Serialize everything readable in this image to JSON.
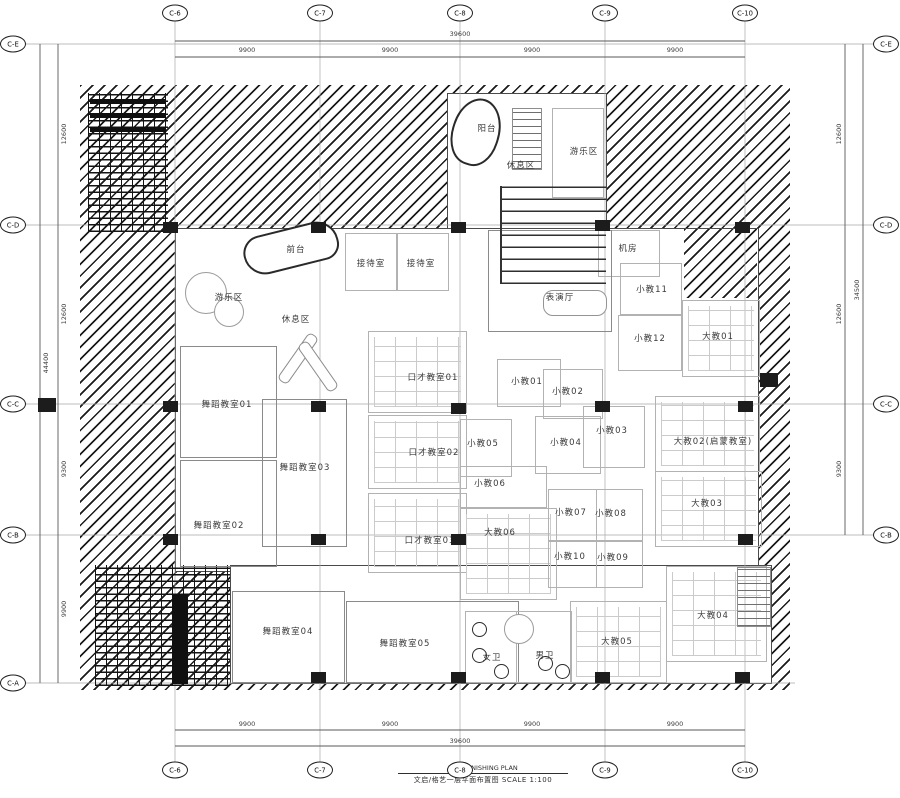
{
  "drawing": {
    "title_en": "F1 FURNISHING PLAN",
    "title_cn": "文启/格艺一层平面布置图",
    "scale": "SCALE 1:100"
  },
  "grid": {
    "top": [
      "C-6",
      "C-7",
      "C-8",
      "C-9",
      "C-10"
    ],
    "bottom": [
      "C-6",
      "C-7",
      "C-8",
      "C-9",
      "C-10"
    ],
    "left": [
      "C-E",
      "C-D",
      "C-C",
      "C-B",
      "C-A"
    ],
    "right": [
      "C-E",
      "C-D",
      "C-C",
      "C-B"
    ]
  },
  "dimensions": {
    "top": {
      "total": "39600",
      "segments": [
        "9900",
        "9900",
        "9900",
        "9900"
      ]
    },
    "bottom": {
      "total": "39600",
      "segments": [
        "9900",
        "9900",
        "9900",
        "9900"
      ]
    },
    "left": {
      "total": "44400",
      "segments": [
        "12600",
        "12600",
        "9300",
        "9900"
      ]
    },
    "right": {
      "total": "34500",
      "segments": [
        "12600",
        "12600",
        "9300"
      ]
    }
  },
  "rooms": {
    "balcony": "阳台",
    "rest_top": "休息区",
    "play_top": "游乐区",
    "front_desk": "前台",
    "reception1": "接待室",
    "reception2": "接待室",
    "machine": "机房",
    "theater": "表演厅",
    "play_left": "游乐区",
    "rest_left": "休息区",
    "dance01": "舞蹈教室01",
    "dance02": "舞蹈教室02",
    "dance03": "舞蹈教室03",
    "dance04": "舞蹈教室04",
    "dance05": "舞蹈教室05",
    "talk01": "口才教室01",
    "talk02": "口才教室02",
    "talk03": "口才教室03",
    "xj01": "小教01",
    "xj02": "小教02",
    "xj03": "小教03",
    "xj04": "小教04",
    "xj05": "小教05",
    "xj06": "小教06",
    "xj07": "小教07",
    "xj08": "小教08",
    "xj09": "小教09",
    "xj10": "小教10",
    "xj11": "小教11",
    "xj12": "小教12",
    "dj01": "大教01",
    "dj02": "大教02(启蒙教室)",
    "dj03": "大教03",
    "dj04": "大教04",
    "dj05": "大教05",
    "dj06": "大教06",
    "wc_f": "女卫",
    "wc_m": "男卫"
  }
}
